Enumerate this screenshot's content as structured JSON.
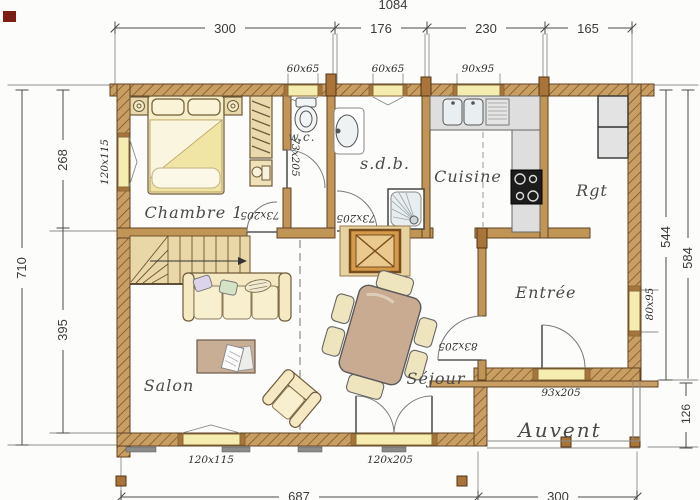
{
  "dimensions": {
    "overall_top": "1084",
    "top": [
      "300",
      "176",
      "230",
      "165"
    ],
    "left_upper": "268",
    "left_lower": "395",
    "left_overall": "710",
    "right_main": "544",
    "right_overall": "584",
    "right_porch": "126",
    "bottom_main": "687",
    "bottom_porch": "300"
  },
  "rooms": {
    "chambre": "Chambre 1",
    "wc": "w.c.",
    "sdb": "s.d.b.",
    "cuisine": "Cuisine",
    "rgt": "Rgt",
    "entree": "Entrée",
    "sejour": "Séjour",
    "salon": "Salon",
    "auvent": "Auvent"
  },
  "openings": {
    "window_wc": "60x65",
    "window_sdb": "60x65",
    "window_cuisine": "90x95",
    "window_chambre": "120x115",
    "window_entree": "80x95",
    "window_salon": "120x115",
    "door_wc": "73x205",
    "door_chambre": "73x205",
    "door_sdb": "73x205",
    "door_sejour": "83x205",
    "door_front": "93x205",
    "door_terrace": "120x205"
  },
  "colors": {
    "wall_wood": "#c89e63",
    "wall_hatch": "#7a5327",
    "interior_wall": "#c09556",
    "window_fill": "#f4edaf",
    "counter_grey": "#dedede",
    "dimension_text": "#3a3a3a"
  }
}
